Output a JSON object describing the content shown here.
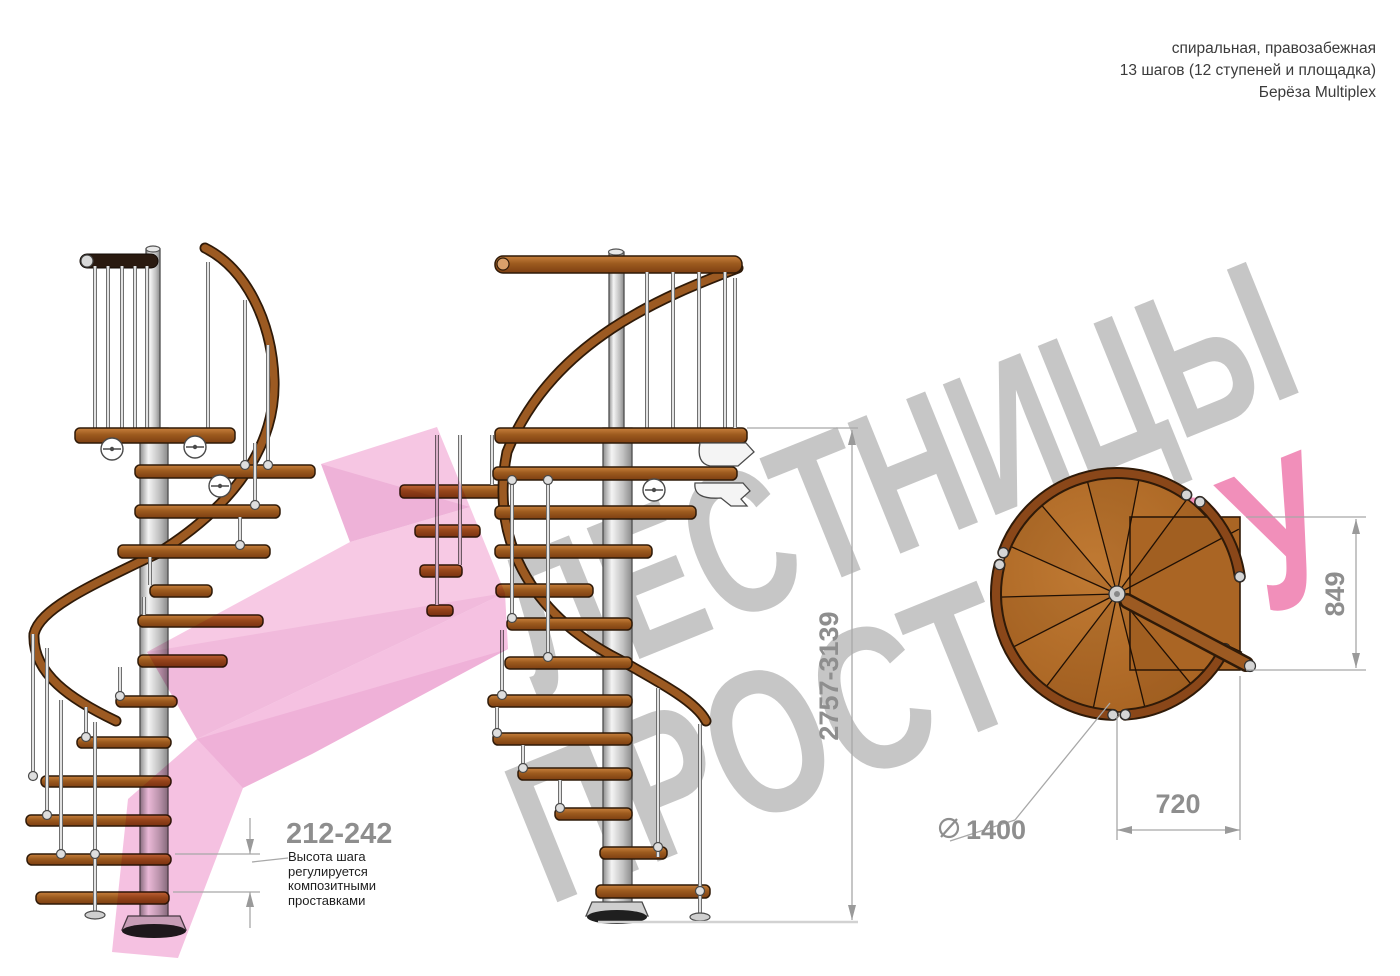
{
  "title_block": {
    "line1": "спиральная, правозабежная",
    "line2": "13 шагов (12 ступеней и площадка)",
    "line3": "Берёза Multiplex"
  },
  "watermark": {
    "word1": "ЛЕСТНИЦЫ",
    "word2_gray": "ПРОСТО",
    "word2_pink": ".РУ",
    "gray_color": "#b9b9b9",
    "pink_color": "#f083b3",
    "arrow_color": "#f5bfe0"
  },
  "dimensions": {
    "step_height": "212-242",
    "step_height_note": [
      "Высота шага",
      "регулируется",
      "композитными",
      "проставками"
    ],
    "total_height": "2757-3139",
    "landing_side": "849",
    "landing_width": "720",
    "diameter_symbol": "⌀",
    "diameter_value": "1400"
  },
  "drawing": {
    "views": [
      "side-view-left",
      "side-view-front",
      "top-view"
    ],
    "steps_total": 13,
    "colors": {
      "wood": "#a2601f",
      "wood_outline": "#2f1a08",
      "metal": "#d6d6d6",
      "dim_line": "#a8a8a8",
      "dim_text": "#8e8e8e",
      "note_text": "#1e1e1e",
      "title_text": "#3b3b3b"
    }
  }
}
